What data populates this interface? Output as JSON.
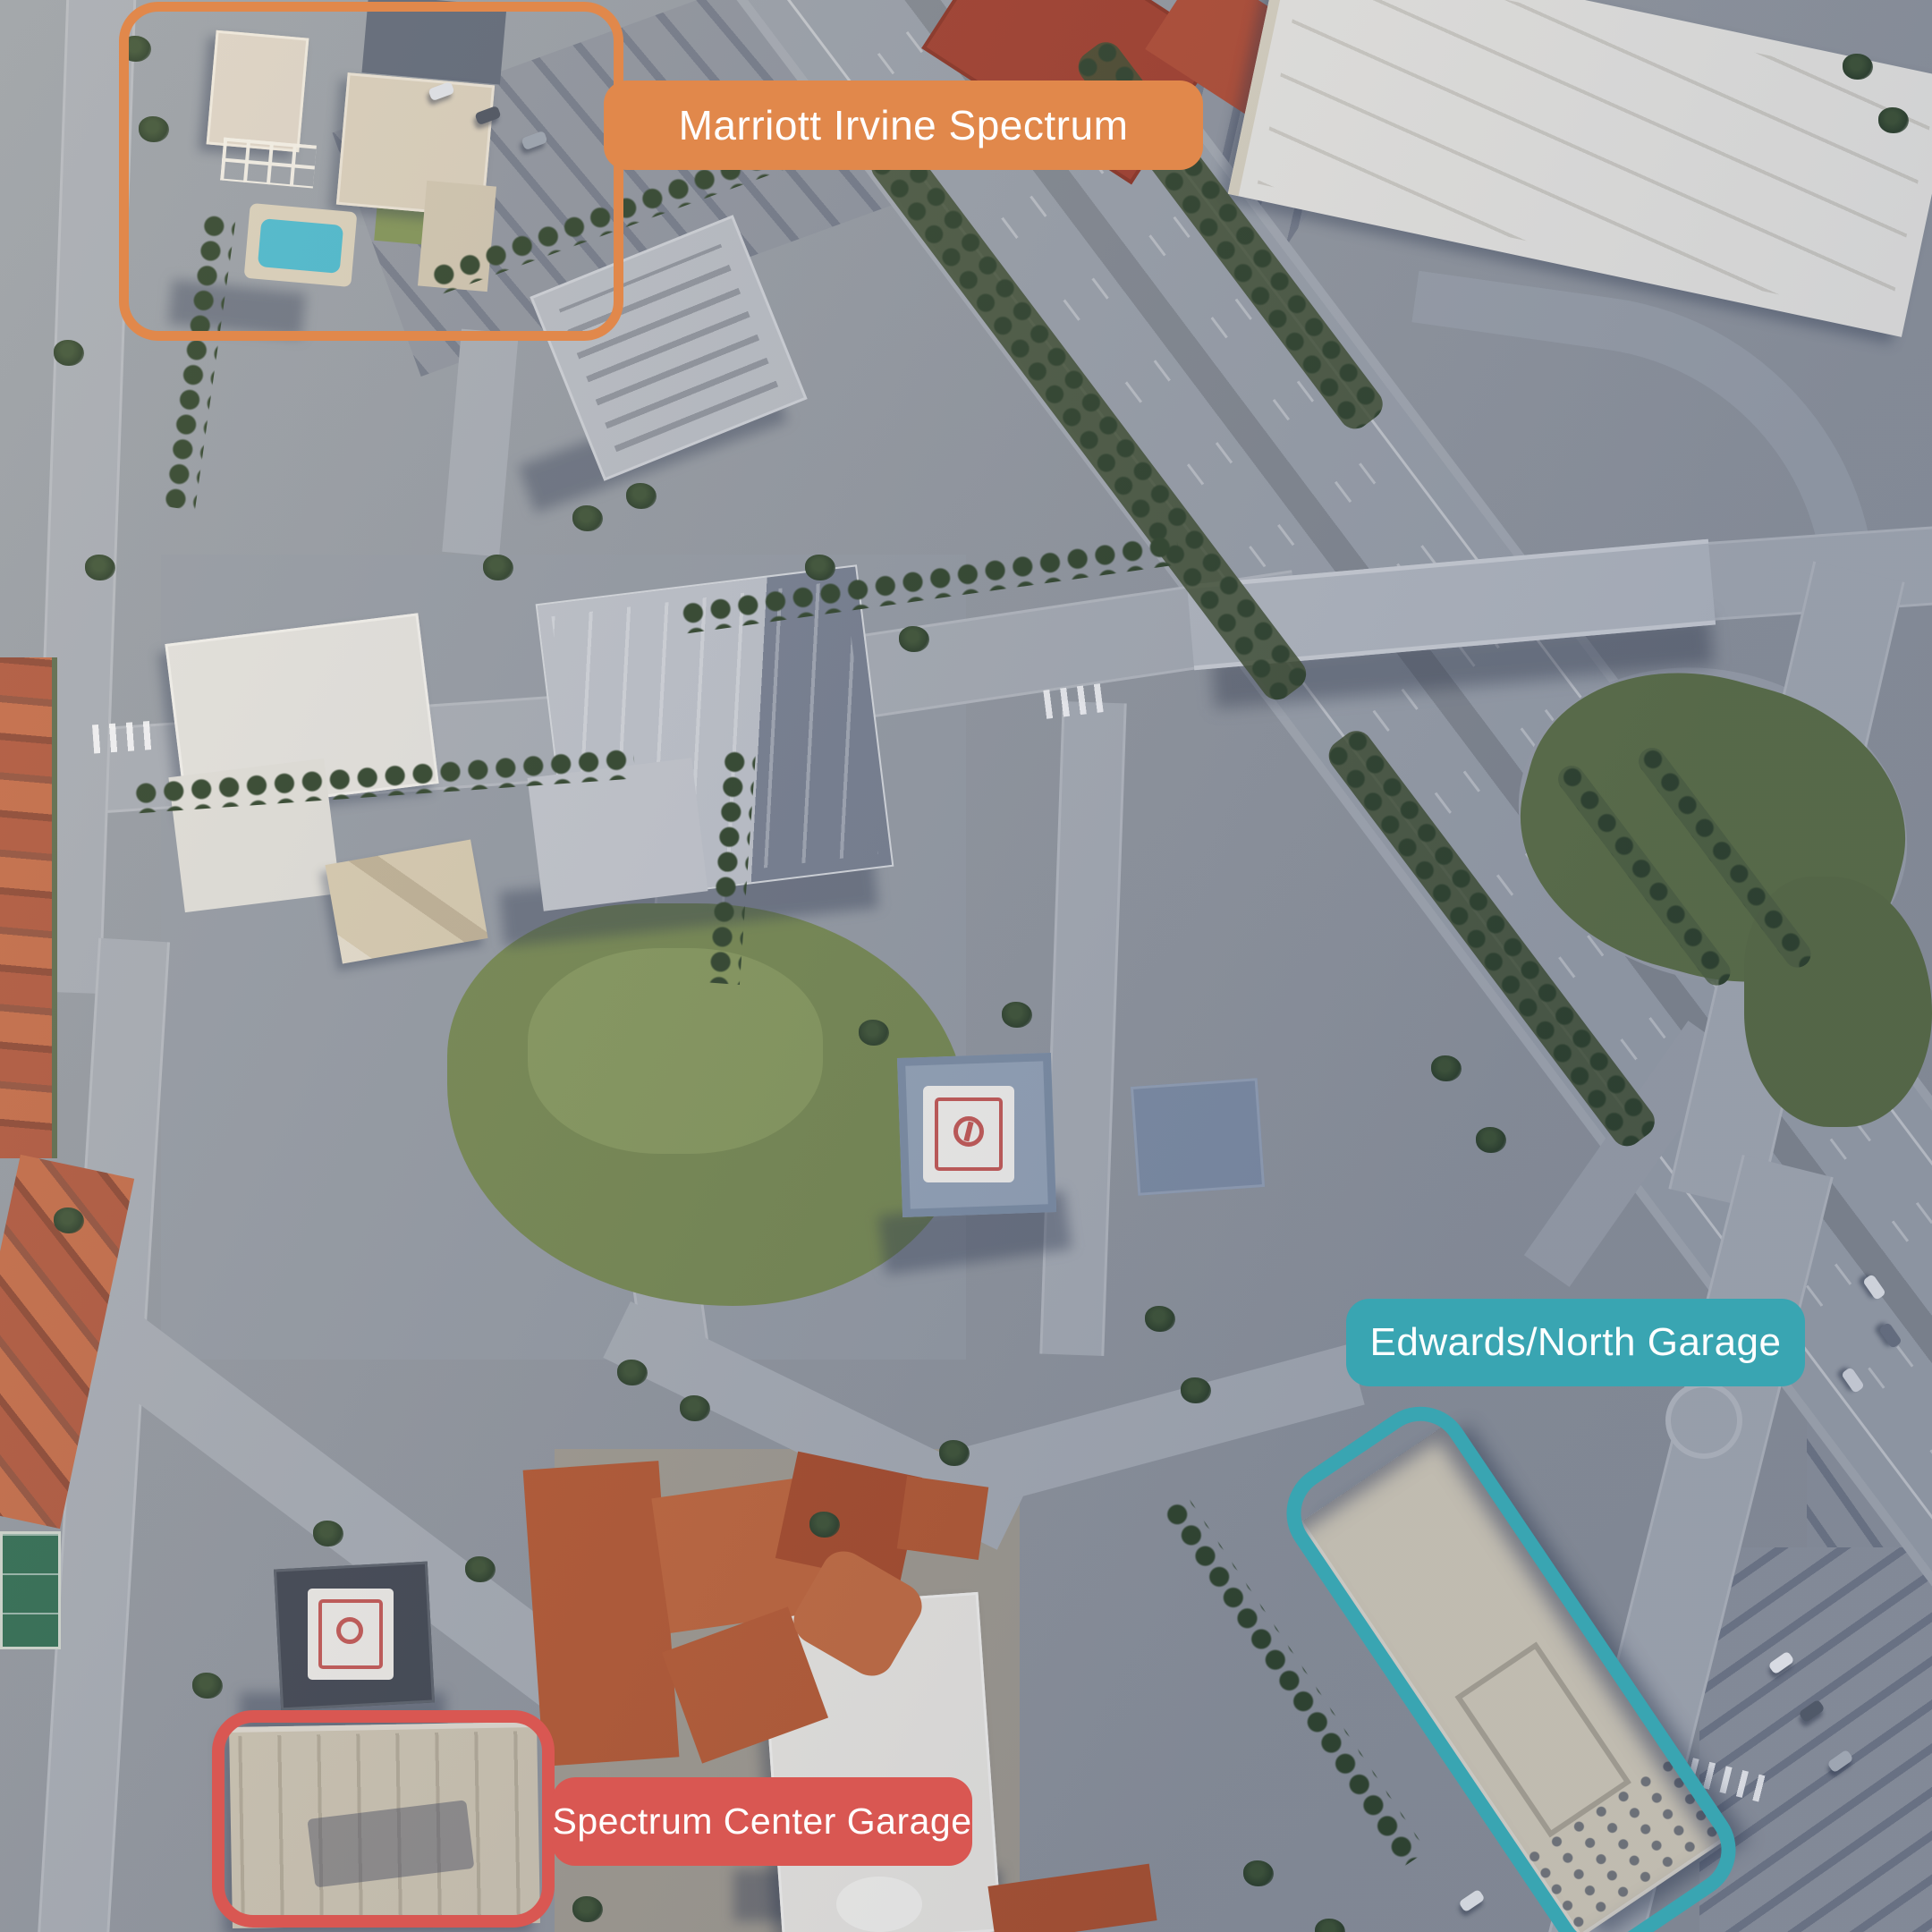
{
  "map_kind": "satellite-aerial",
  "label_text_color": "#FFFFFF",
  "annotations": [
    {
      "id": "marriott",
      "name": "Marriott Irvine Spectrum",
      "color": "#E1884B"
    },
    {
      "id": "edwards-north-garage",
      "name": "Edwards/North Garage",
      "color": "#39A5B2"
    },
    {
      "id": "spectrum-center-garage",
      "name": "Spectrum Center Garage",
      "color": "#D95752"
    }
  ]
}
